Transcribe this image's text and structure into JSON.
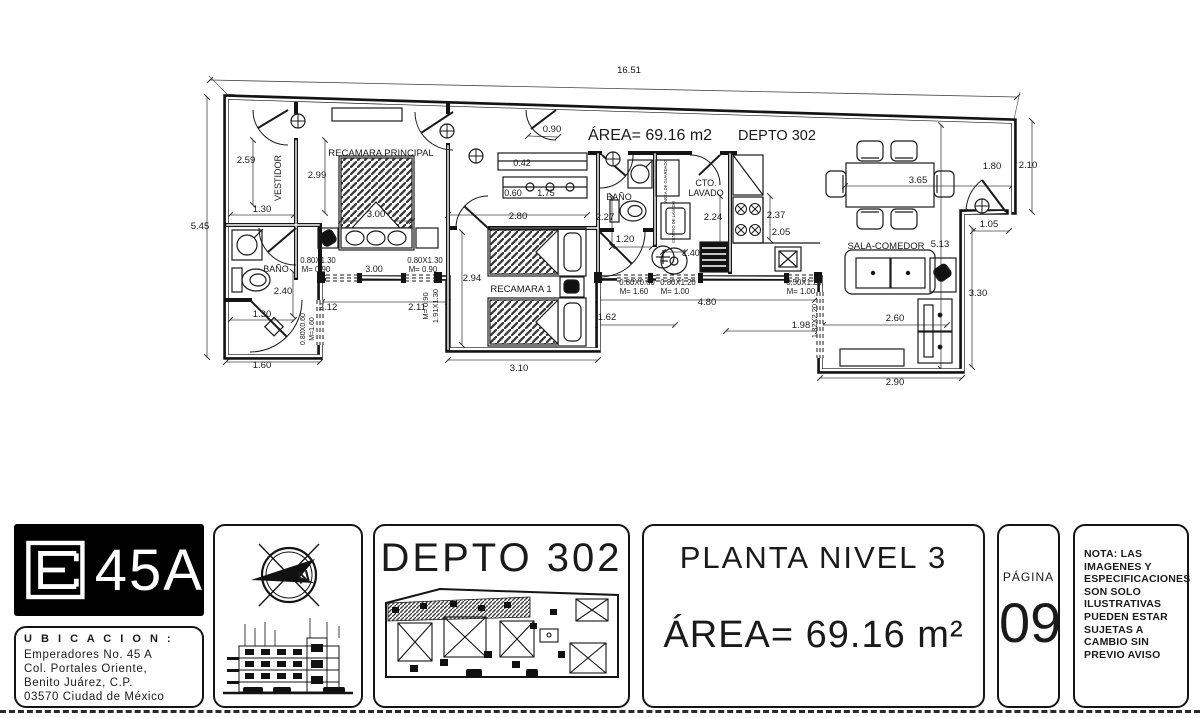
{
  "ink": "#1a1a1a",
  "plan": {
    "labels": [
      {
        "t": "ÁREA= 69.16 m2",
        "x": 588,
        "y": 140,
        "s": 16,
        "a": "start",
        "n": "plan-area-title"
      },
      {
        "t": "DEPTO 302",
        "x": 738,
        "y": 140,
        "s": 14.5,
        "a": "start",
        "n": "plan-unit-title"
      },
      {
        "t": "VESTIDOR",
        "x": 281,
        "y": 178,
        "r": -90,
        "s": 9,
        "n": "room-label"
      },
      {
        "t": "RECAMARA PRINCIPAL",
        "x": 381,
        "y": 156,
        "s": 9.5,
        "n": "room-label"
      },
      {
        "t": "RECAMARA 1",
        "x": 521,
        "y": 292,
        "s": 9.5,
        "n": "room-label"
      },
      {
        "t": "BAÑO",
        "x": 276,
        "y": 272,
        "s": 9,
        "n": "room-label"
      },
      {
        "t": "BAÑO",
        "x": 619,
        "y": 200,
        "s": 9,
        "n": "room-label"
      },
      {
        "t": "CTO.",
        "x": 706,
        "y": 186,
        "s": 9,
        "n": "room-label"
      },
      {
        "t": "LAVADO",
        "x": 706,
        "y": 196,
        "s": 9,
        "n": "room-label"
      },
      {
        "t": "SALA-COMEDOR",
        "x": 886,
        "y": 249,
        "s": 9.5,
        "n": "room-label"
      },
      {
        "t": "AREA DE GUARDADO",
        "x": 667,
        "y": 181,
        "r": -90,
        "s": 4.2,
        "n": "room-label"
      },
      {
        "t": "CENTRO DE LAVADO",
        "x": 675,
        "y": 222,
        "r": -90,
        "s": 4.2,
        "n": "room-label"
      },
      {
        "t": "16.51",
        "x": 629,
        "y": 73
      },
      {
        "t": "0.90",
        "x": 552,
        "y": 132
      },
      {
        "t": "5.45",
        "x": 200,
        "y": 229
      },
      {
        "t": "2.59",
        "x": 246,
        "y": 163
      },
      {
        "t": "1.30",
        "x": 262,
        "y": 212
      },
      {
        "t": "2.99",
        "x": 317,
        "y": 178
      },
      {
        "t": "3.00",
        "x": 376,
        "y": 217
      },
      {
        "t": "0.80X1.30",
        "x": 318,
        "y": 263,
        "s": 7.8
      },
      {
        "t": "M= 0.90",
        "x": 316,
        "y": 272,
        "s": 7.8
      },
      {
        "t": "3.00",
        "x": 374,
        "y": 272,
        "s": 9
      },
      {
        "t": "0.80X1.30",
        "x": 425,
        "y": 263,
        "s": 7.8
      },
      {
        "t": "M= 0.90",
        "x": 423,
        "y": 272,
        "s": 7.8
      },
      {
        "t": "2.12",
        "x": 328,
        "y": 310
      },
      {
        "t": "2.11",
        "x": 417,
        "y": 310
      },
      {
        "t": "M= 0.90",
        "x": 428,
        "y": 306,
        "r": -90,
        "s": 7.5
      },
      {
        "t": "1.91X1.30",
        "x": 438,
        "y": 306,
        "r": -90,
        "s": 7.5
      },
      {
        "t": "2.94",
        "x": 472,
        "y": 281
      },
      {
        "t": "2.80",
        "x": 518,
        "y": 219
      },
      {
        "t": "0.42",
        "x": 522,
        "y": 166,
        "s": 9
      },
      {
        "t": "0.60",
        "x": 513,
        "y": 196,
        "s": 9
      },
      {
        "t": "1.75",
        "x": 546,
        "y": 196,
        "s": 9
      },
      {
        "t": "3.10",
        "x": 519,
        "y": 371
      },
      {
        "t": "2.40",
        "x": 283,
        "y": 294
      },
      {
        "t": "1.30",
        "x": 262,
        "y": 317
      },
      {
        "t": "1.60",
        "x": 262,
        "y": 368
      },
      {
        "t": "0.80X0.60",
        "x": 305,
        "y": 329,
        "r": -90,
        "s": 7
      },
      {
        "t": "M=1.60",
        "x": 314,
        "y": 329,
        "r": -90,
        "s": 7
      },
      {
        "t": "2.27",
        "x": 605,
        "y": 220
      },
      {
        "t": "1.20",
        "x": 625,
        "y": 242
      },
      {
        "t": "1.40",
        "x": 691,
        "y": 256,
        "s": 9
      },
      {
        "t": "2.24",
        "x": 713,
        "y": 220
      },
      {
        "t": "2.37",
        "x": 776,
        "y": 218
      },
      {
        "t": "2.05",
        "x": 781,
        "y": 235
      },
      {
        "t": "0.80X0.60",
        "x": 637,
        "y": 285,
        "s": 7.8
      },
      {
        "t": "M= 1.60",
        "x": 634,
        "y": 294,
        "s": 7.8
      },
      {
        "t": "0.80X1.20",
        "x": 678,
        "y": 285,
        "s": 7.8
      },
      {
        "t": "M= 1.00",
        "x": 675,
        "y": 294,
        "s": 7.8
      },
      {
        "t": "0.50X1.20",
        "x": 804,
        "y": 285,
        "s": 7.8
      },
      {
        "t": "M= 1.00",
        "x": 801,
        "y": 294,
        "s": 7.8
      },
      {
        "t": "4.80",
        "x": 707,
        "y": 305
      },
      {
        "t": "1.62",
        "x": 607,
        "y": 320
      },
      {
        "t": "1.98",
        "x": 801,
        "y": 328
      },
      {
        "t": "1.82X2.20",
        "x": 817,
        "y": 321,
        "r": -90,
        "s": 7.5
      },
      {
        "t": "3.65",
        "x": 918,
        "y": 183
      },
      {
        "t": "1.80",
        "x": 992,
        "y": 169
      },
      {
        "t": "2.10",
        "x": 1028,
        "y": 168
      },
      {
        "t": "1.05",
        "x": 989,
        "y": 227
      },
      {
        "t": "5.13",
        "x": 940,
        "y": 247
      },
      {
        "t": "3.30",
        "x": 978,
        "y": 296
      },
      {
        "t": "2.60",
        "x": 895,
        "y": 321
      },
      {
        "t": "2.90",
        "x": 895,
        "y": 385
      }
    ]
  },
  "titleblock": {
    "logo_text": "45A",
    "ubicacion_title": "U B I C A C I O N :",
    "ubicacion_lines": [
      "Emperadores  No.  45  A",
      "Col.  Portales  Oriente,",
      "Benito  Juárez,  C.P.",
      "03570  Ciudad  de  México"
    ],
    "depto_title": "DEPTO  302",
    "planta_title": "PLANTA  NIVEL  3",
    "area_value": "ÁREA=  69.16  m²",
    "pagina_label": "PÁGINA",
    "pagina_number": "09",
    "nota_lines": [
      "NOTA:  LAS",
      "IMAGENES  Y",
      "ESPECIFICACIONES",
      "SON  SOLO",
      "ILUSTRATIVAS",
      "PUEDEN  ESTAR",
      "SUJETAS  A",
      "CAMBIO  SIN",
      "PREVIO  AVISO"
    ]
  }
}
